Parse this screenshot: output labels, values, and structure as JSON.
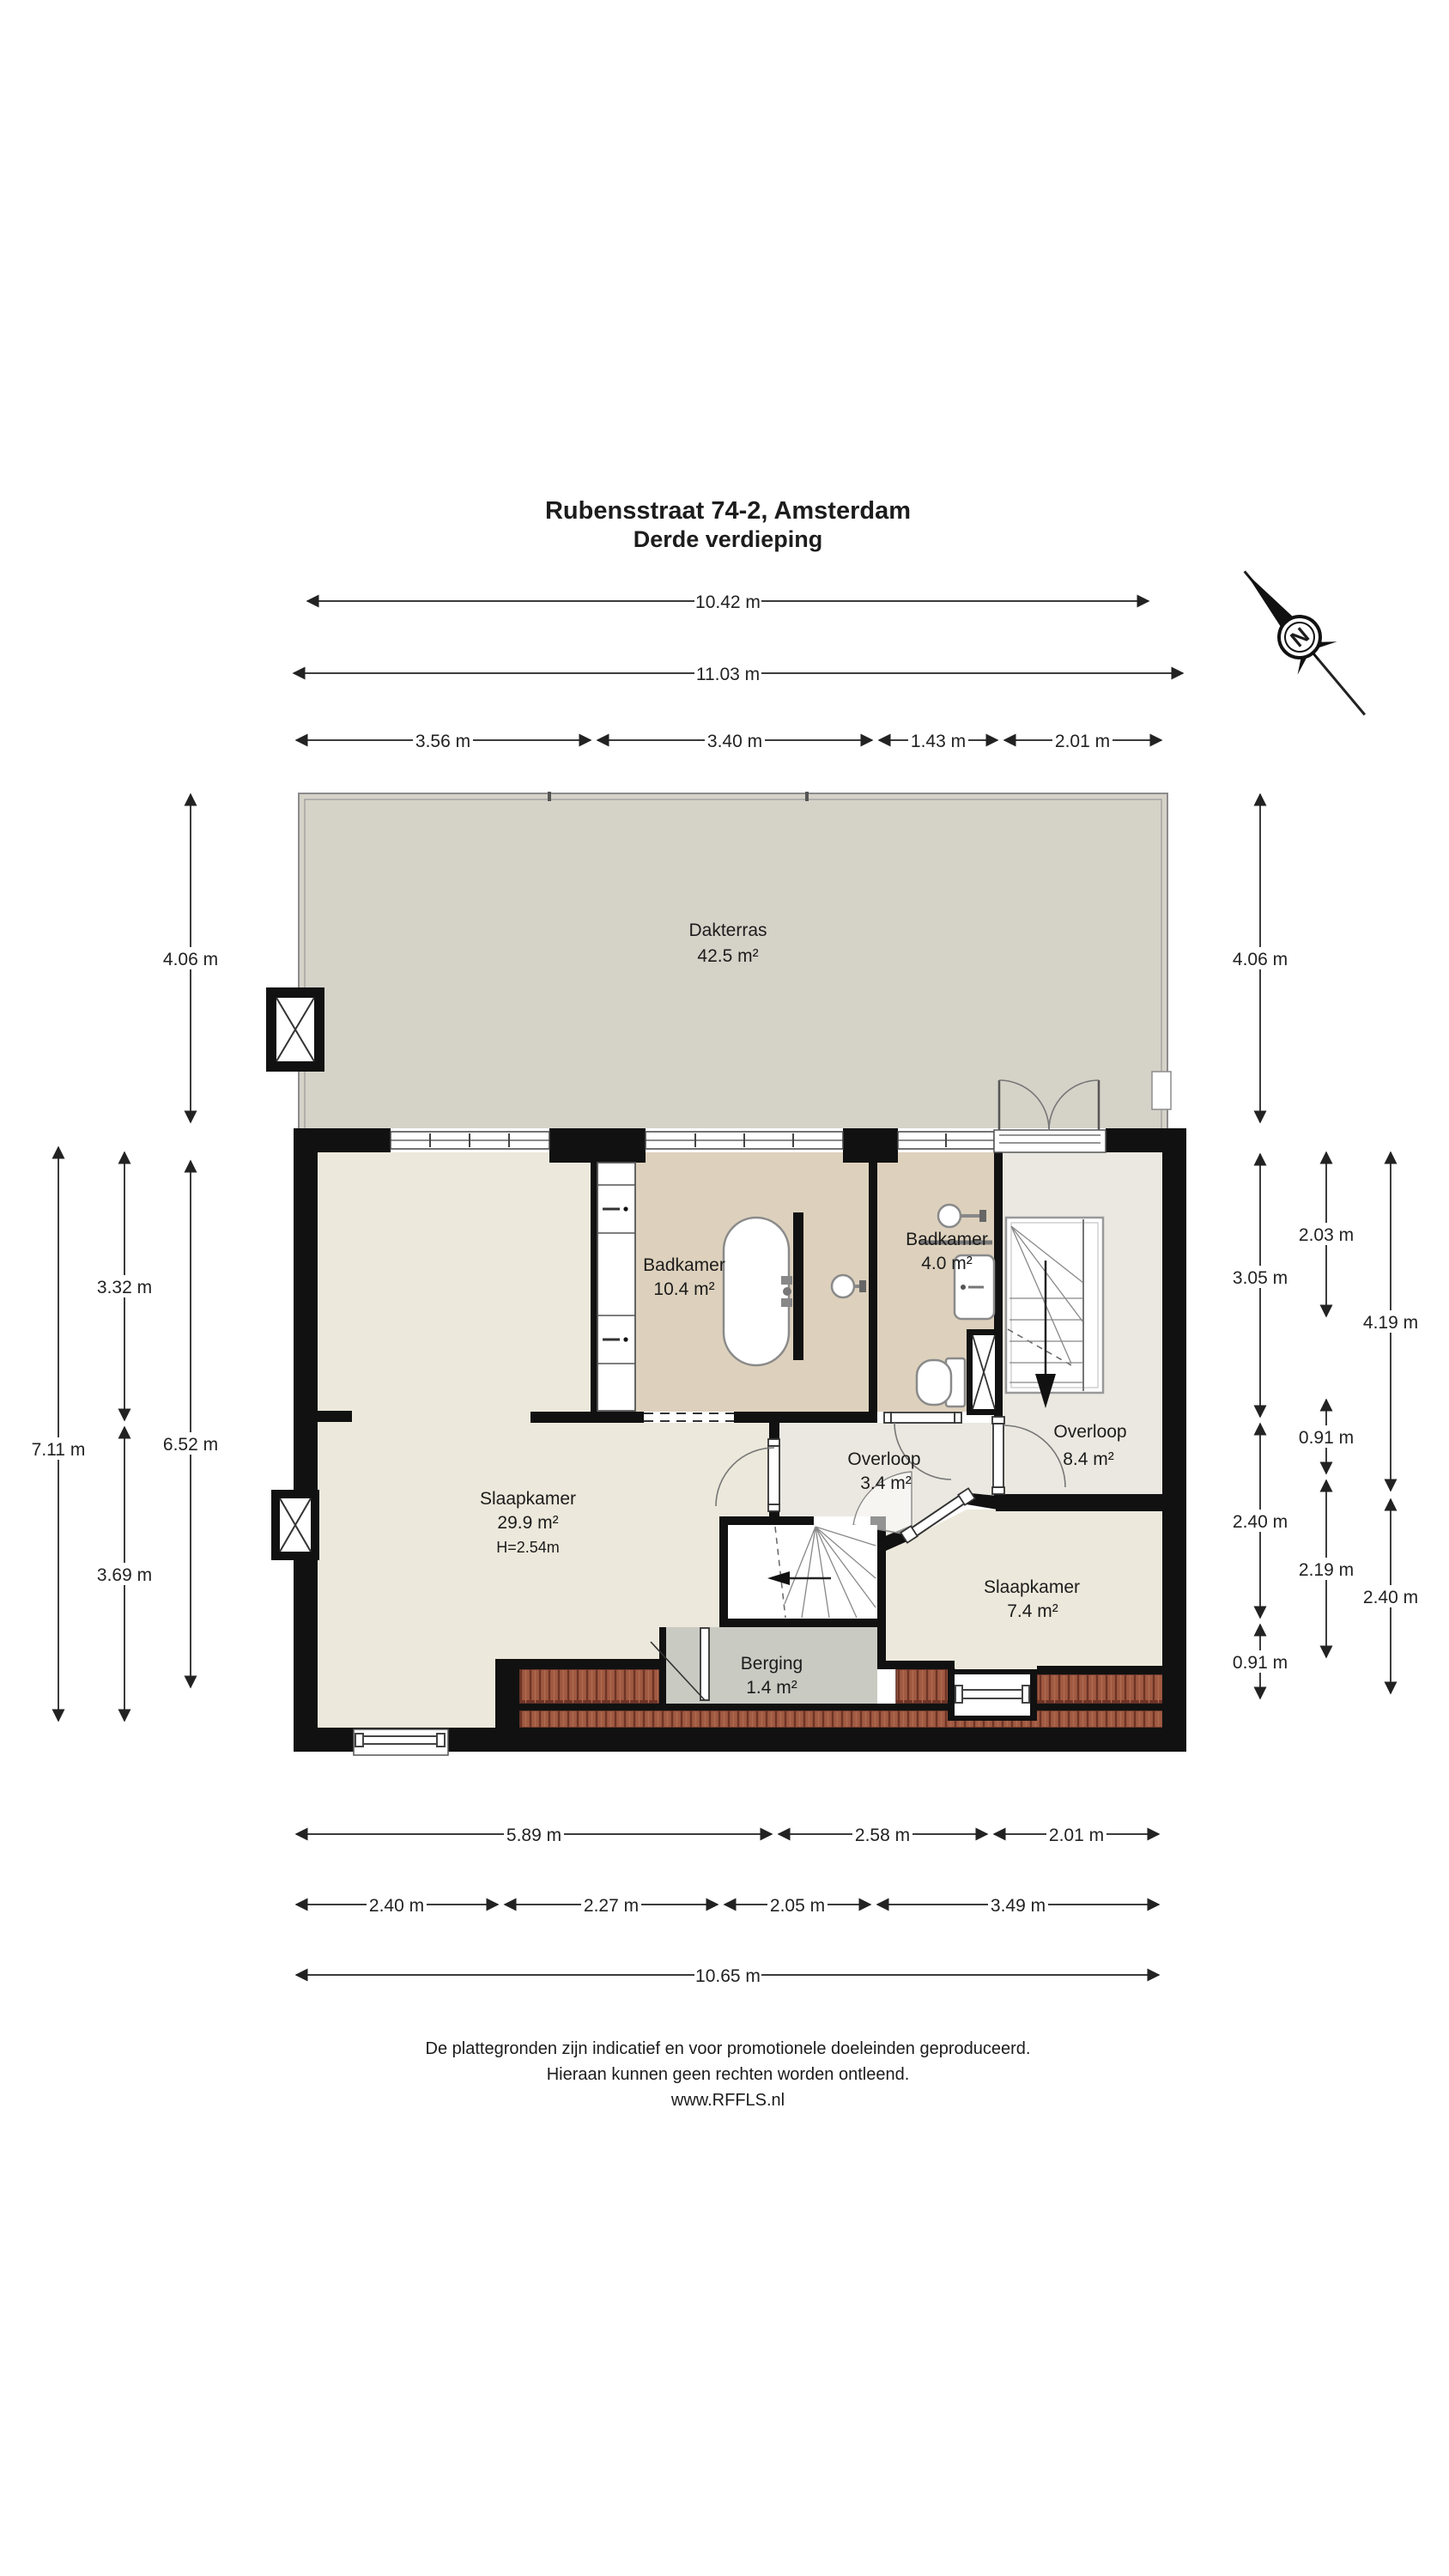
{
  "title": {
    "line1": "Rubensstraat 74-2, Amsterdam",
    "line2": "Derde verdieping"
  },
  "compass": {
    "north": "N"
  },
  "rooms": {
    "dakterras": {
      "name": "Dakterras",
      "area": "42.5 m²"
    },
    "slaapkamer_groot": {
      "name": "Slaapkamer",
      "area": "29.9 m²",
      "height": "H=2.54m"
    },
    "badkamer_groot": {
      "name": "Badkamer",
      "area": "10.4 m²"
    },
    "badkamer_klein": {
      "name": "Badkamer",
      "area": "4.0 m²"
    },
    "overloop_klein": {
      "name": "Overloop",
      "area": "3.4 m²"
    },
    "overloop_groot": {
      "name": "Overloop",
      "area": "8.4 m²"
    },
    "slaapkamer_klein": {
      "name": "Slaapkamer",
      "area": "7.4 m²"
    },
    "berging": {
      "name": "Berging",
      "area": "1.4 m²"
    }
  },
  "dims": {
    "top": {
      "w1": "10.42 m",
      "w2": "11.03 m",
      "s1": "3.56 m",
      "s2": "3.40 m",
      "s3": "1.43 m",
      "s4": "2.01 m"
    },
    "left": {
      "terras": "4.06 m",
      "totaal": "7.11 m",
      "boven": "3.32 m",
      "binnen": "6.52 m",
      "onder": "3.69 m"
    },
    "right": {
      "terras": "4.06 m",
      "r1a": "3.05 m",
      "r1b": "2.40 m",
      "r1c": "0.91 m",
      "r2a": "2.03 m",
      "r2b": "0.91 m",
      "r2c": "2.19 m",
      "r3a": "4.19 m",
      "r3b": "2.40 m"
    },
    "bottom": {
      "a1": "5.89 m",
      "a2": "2.58 m",
      "a3": "2.01 m",
      "b1": "2.40 m",
      "b2": "2.27 m",
      "b3": "2.05 m",
      "b4": "3.49 m",
      "totaal": "10.65 m"
    }
  },
  "footer": {
    "line1": "De plattegronden zijn indicatief en voor promotionele doeleinden geproduceerd.",
    "line2": "Hieraan kunnen geen rechten worden ontleend.",
    "line3": "www.RFFLS.nl"
  },
  "colors": {
    "wall": "#111111",
    "terrace": "#d5d2c8",
    "bedroom": "#ece8db",
    "bathroom": "#ddd1bd",
    "hall": "#eae8e0",
    "storage": "#c9cbc3",
    "tile": "#a15a42",
    "tileline": "#6e3425",
    "dim": "#3c3c3c",
    "ink": "#1c1c1c"
  }
}
